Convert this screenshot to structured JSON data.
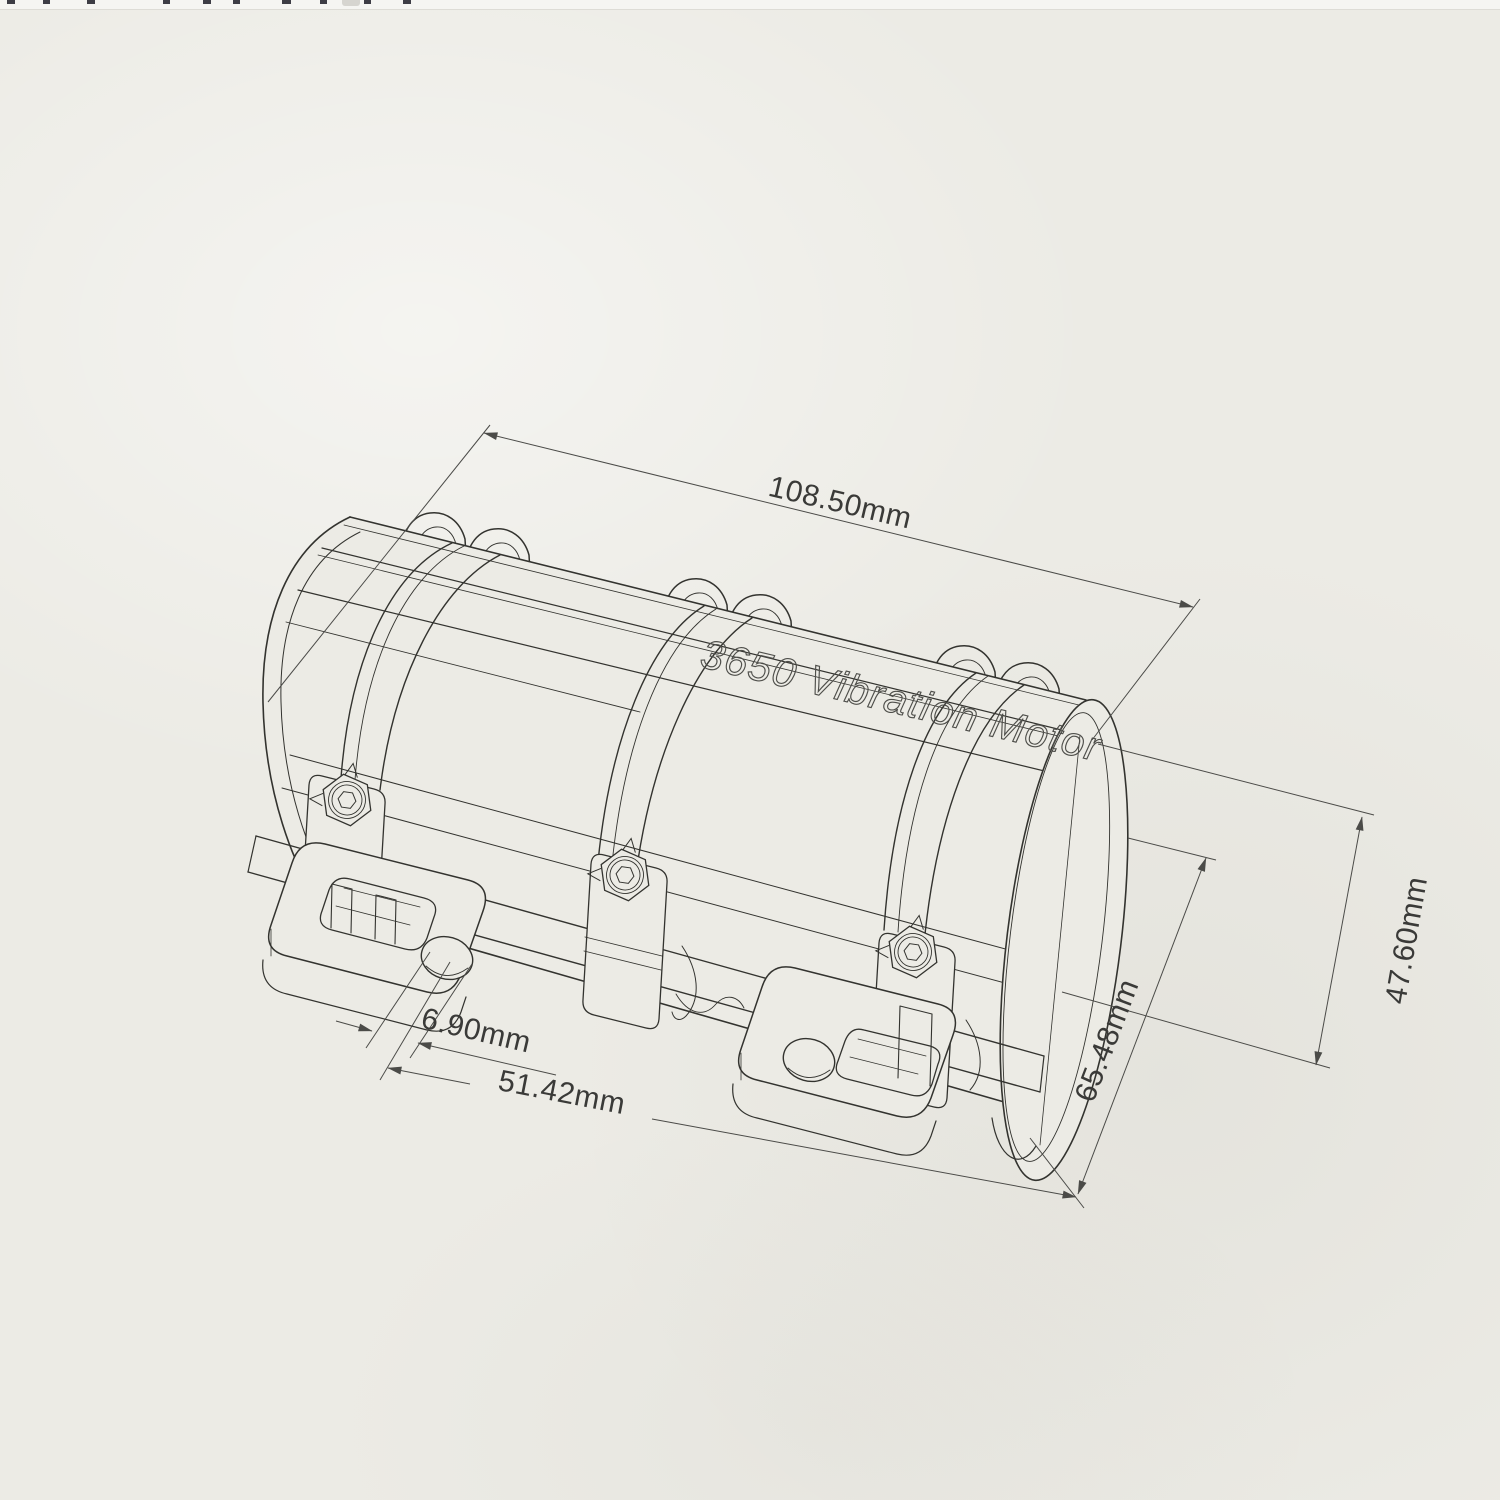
{
  "page": {
    "background_color": "#ecebe5",
    "top_strip_color": "#f5f5f2",
    "line_color": "#33332f",
    "dim_line_color": "#4b4b48"
  },
  "drawing": {
    "engraving": "3650 Vibration Motor",
    "dimensions": {
      "length": {
        "label": "108.50mm"
      },
      "height": {
        "label": "47.60mm"
      },
      "depth": {
        "label": "65.48mm"
      },
      "hole_diameter": {
        "label": "6.90mm"
      },
      "hole_spacing": {
        "label": "51.42mm"
      }
    }
  }
}
